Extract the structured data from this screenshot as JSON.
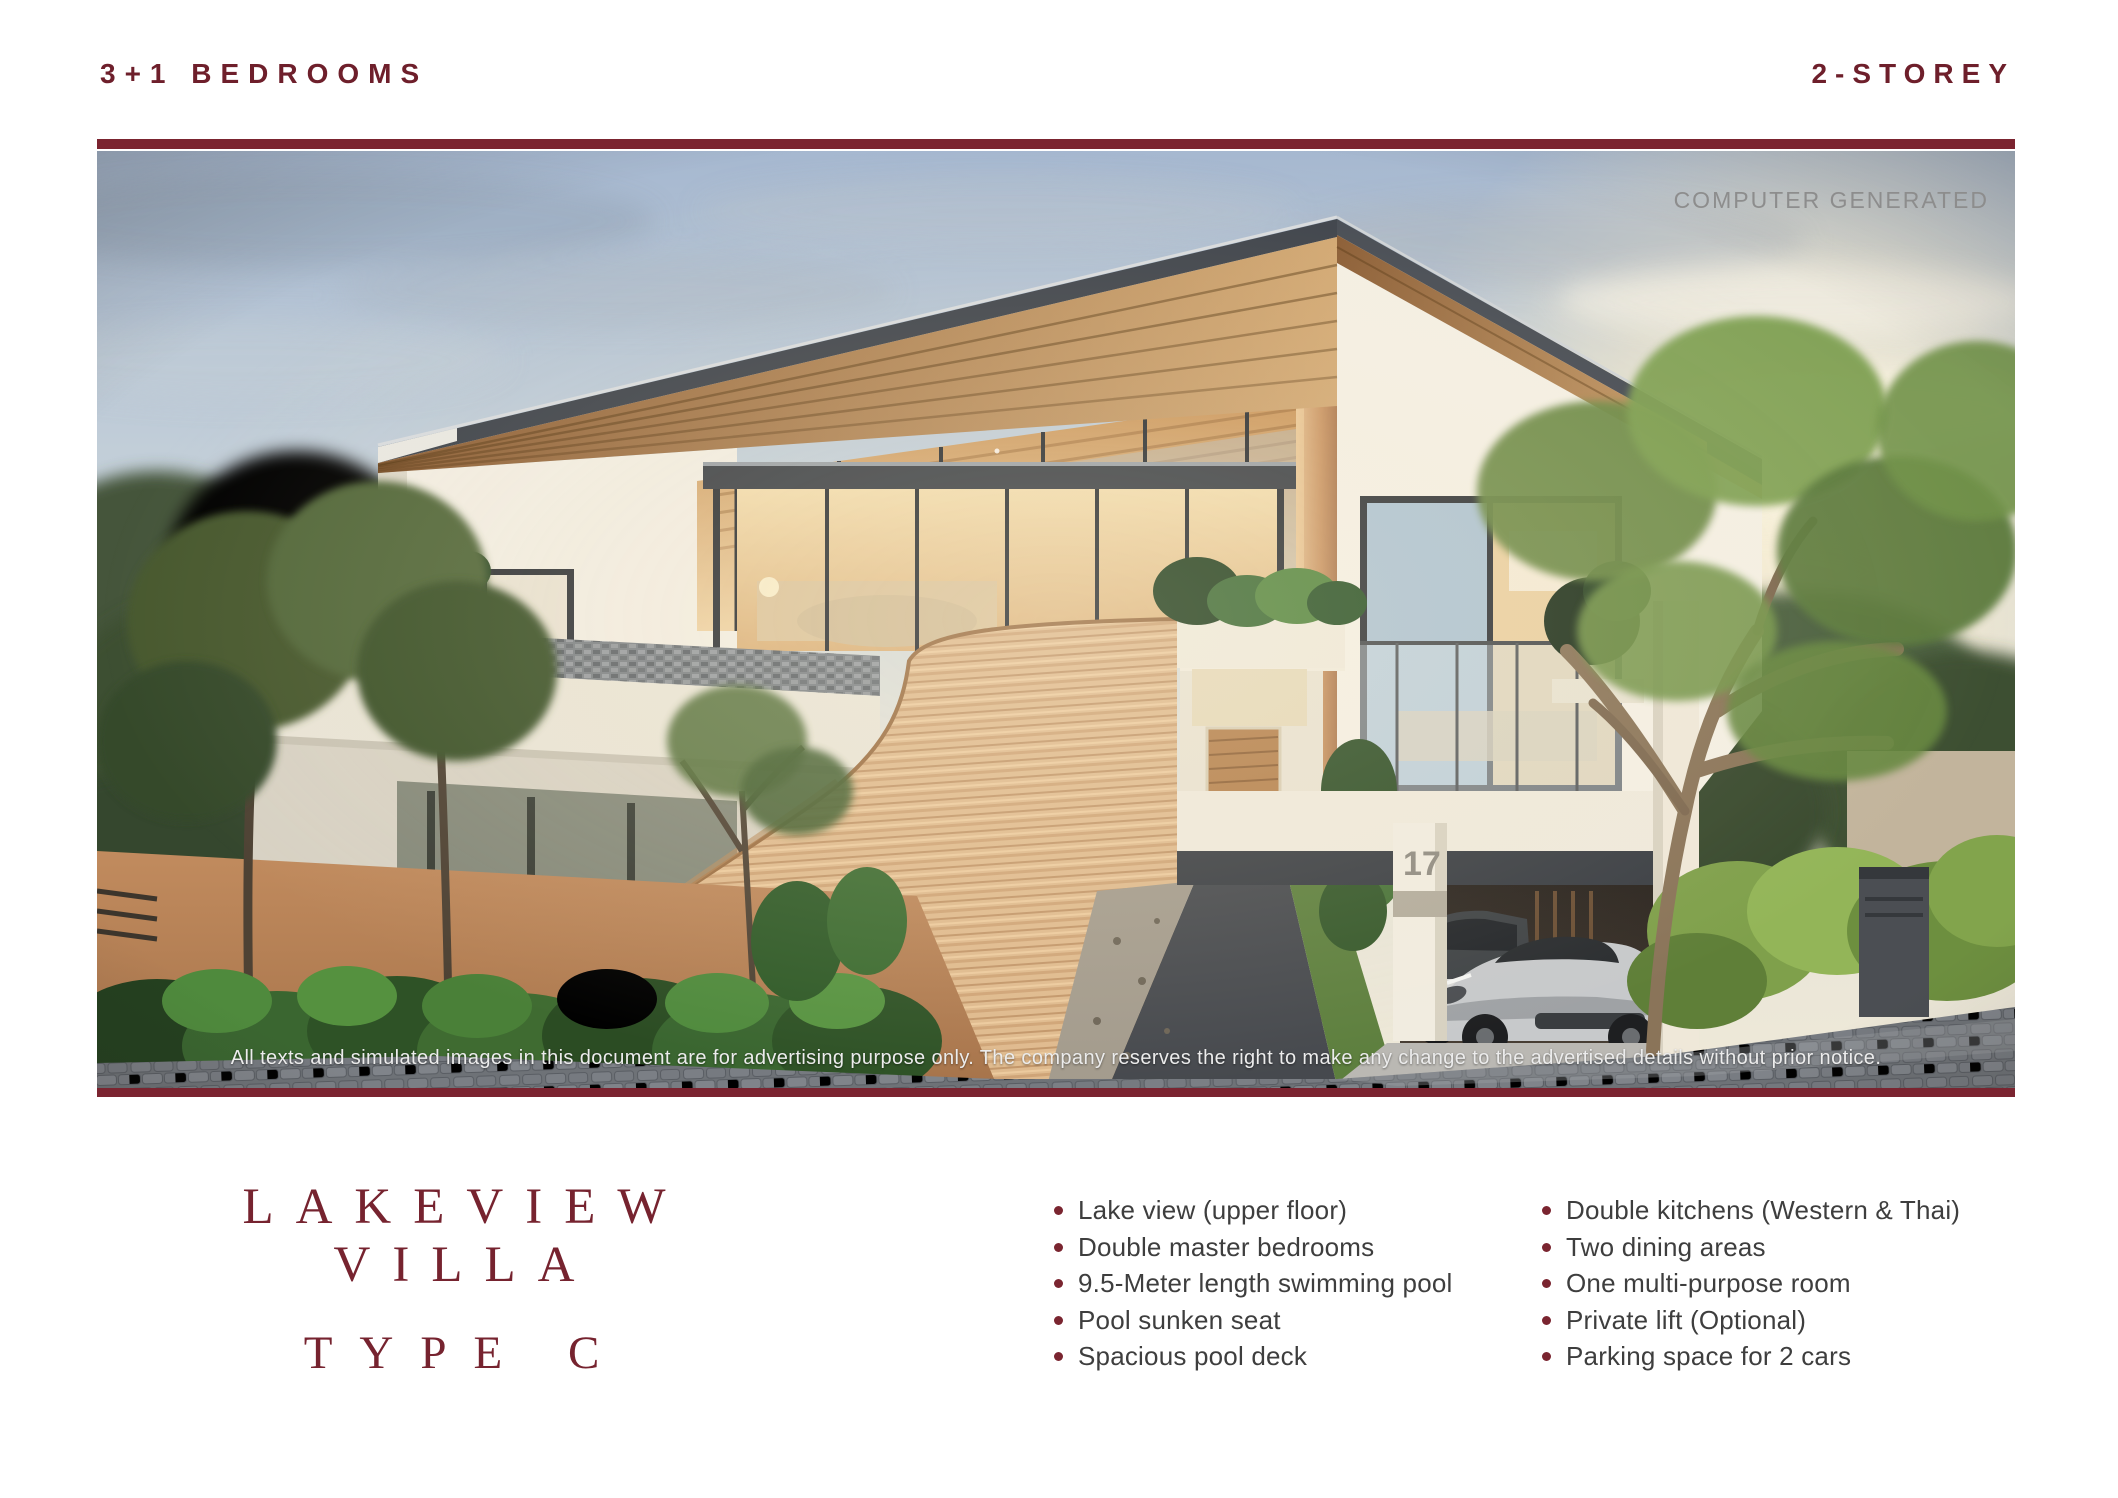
{
  "header": {
    "left": "3+1 BEDROOMS",
    "right": "2-STOREY"
  },
  "image": {
    "watermark": "COMPUTER GENERATED",
    "house_number": "17",
    "disclaimer": "All texts and simulated images in this document are for advertising purpose only. The company reserves the right to make any change to the advertised details without prior notice."
  },
  "title": {
    "line1": "LAKEVIEW VILLA",
    "line2": "TYPE C"
  },
  "features": {
    "column1": [
      "Lake view (upper floor)",
      "Double master bedrooms",
      "9.5-Meter length swimming pool",
      "Pool sunken seat",
      "Spacious pool deck"
    ],
    "column2": [
      "Double kitchens (Western & Thai)",
      "Two dining areas",
      "One multi-purpose room",
      "Private lift (Optional)",
      "Parking space for 2 cars"
    ]
  },
  "colors": {
    "maroon_accent": "#7B2430",
    "title_text": "#76232F",
    "body_text": "#3E3E3E",
    "watermark_gray": "#8D8D8D"
  }
}
